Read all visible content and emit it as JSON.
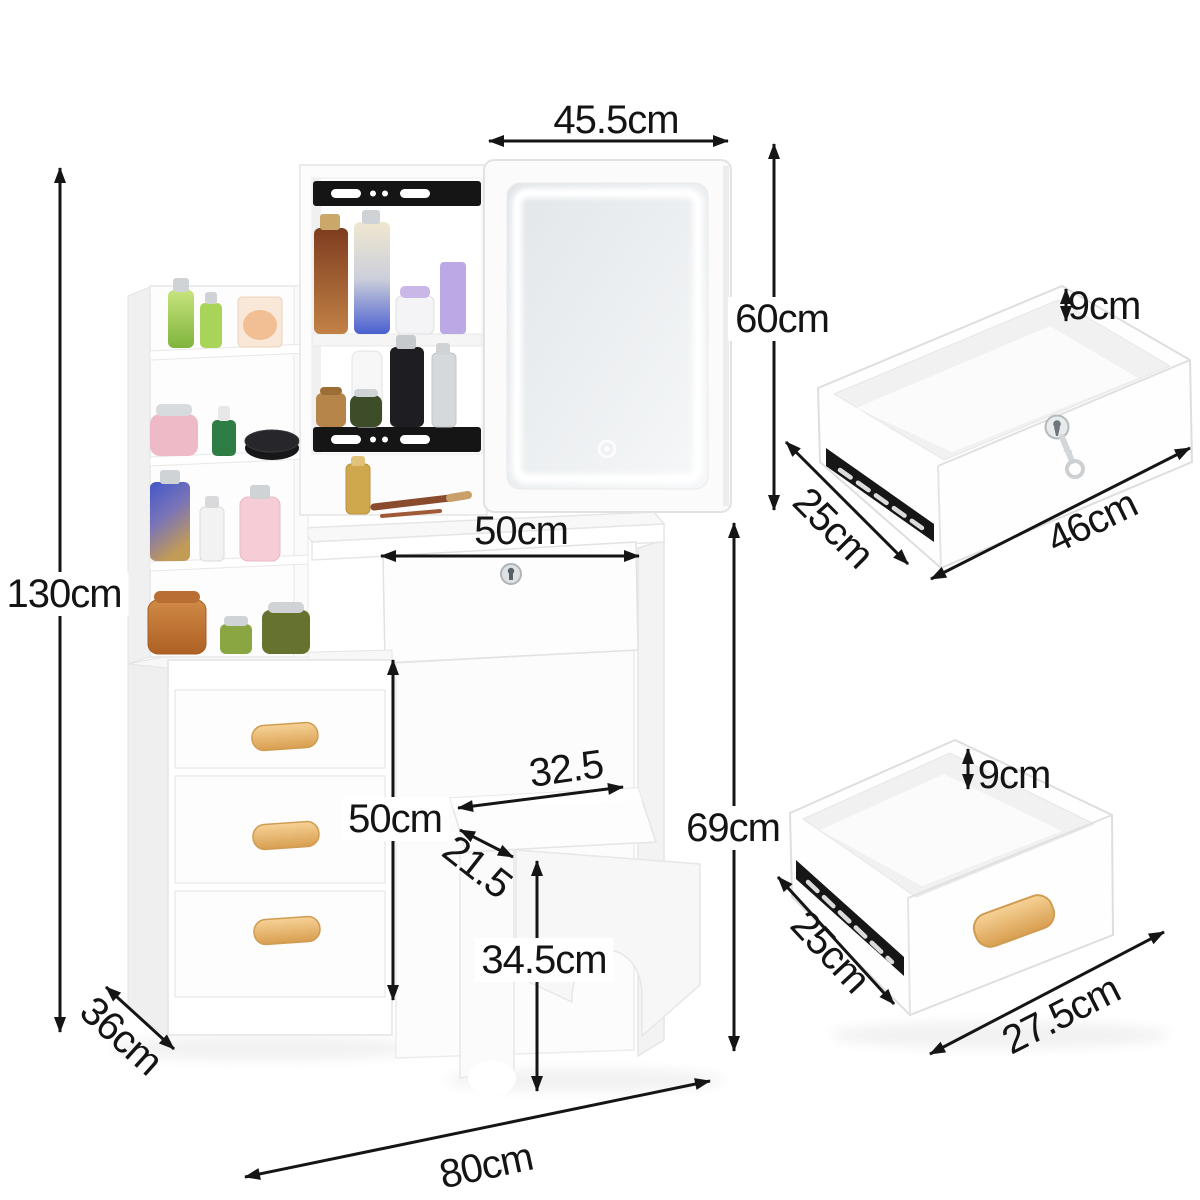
{
  "product": "vanity-dressing-table-dimension-diagram",
  "units": "cm",
  "dimensions": {
    "mirror_width": "45.5cm",
    "mirror_height": "60cm",
    "total_height": "130cm",
    "desktop_drawer_width": "50cm",
    "knee_clearance_height": "50cm",
    "stool_seat_width": "32.5",
    "stool_seat_depth": "21.5",
    "table_height": "69cm",
    "stool_height": "34.5cm",
    "cabinet_depth": "36cm",
    "overall_width": "80cm",
    "top_drawer": {
      "height": "9cm",
      "depth": "25cm",
      "width": "46cm"
    },
    "bottom_drawer": {
      "height": "9cm",
      "depth": "25cm",
      "width": "27.5cm"
    }
  },
  "colors": {
    "background": "#ffffff",
    "arrow": "#151515",
    "furniture": "#fdfdfd",
    "furniture_edge": "#e4e4e4",
    "wood_handle": "#e2a95e",
    "slide_rail": "#151515",
    "led_ring": "#ffffff"
  },
  "icons": {
    "lock": "keyhole-icon",
    "key": "key-icon",
    "touch_sensor": "touch-sensor-icon",
    "slide_rail": "drawer-slide-rail-icon",
    "arrows": "dimension-arrow-icon"
  }
}
